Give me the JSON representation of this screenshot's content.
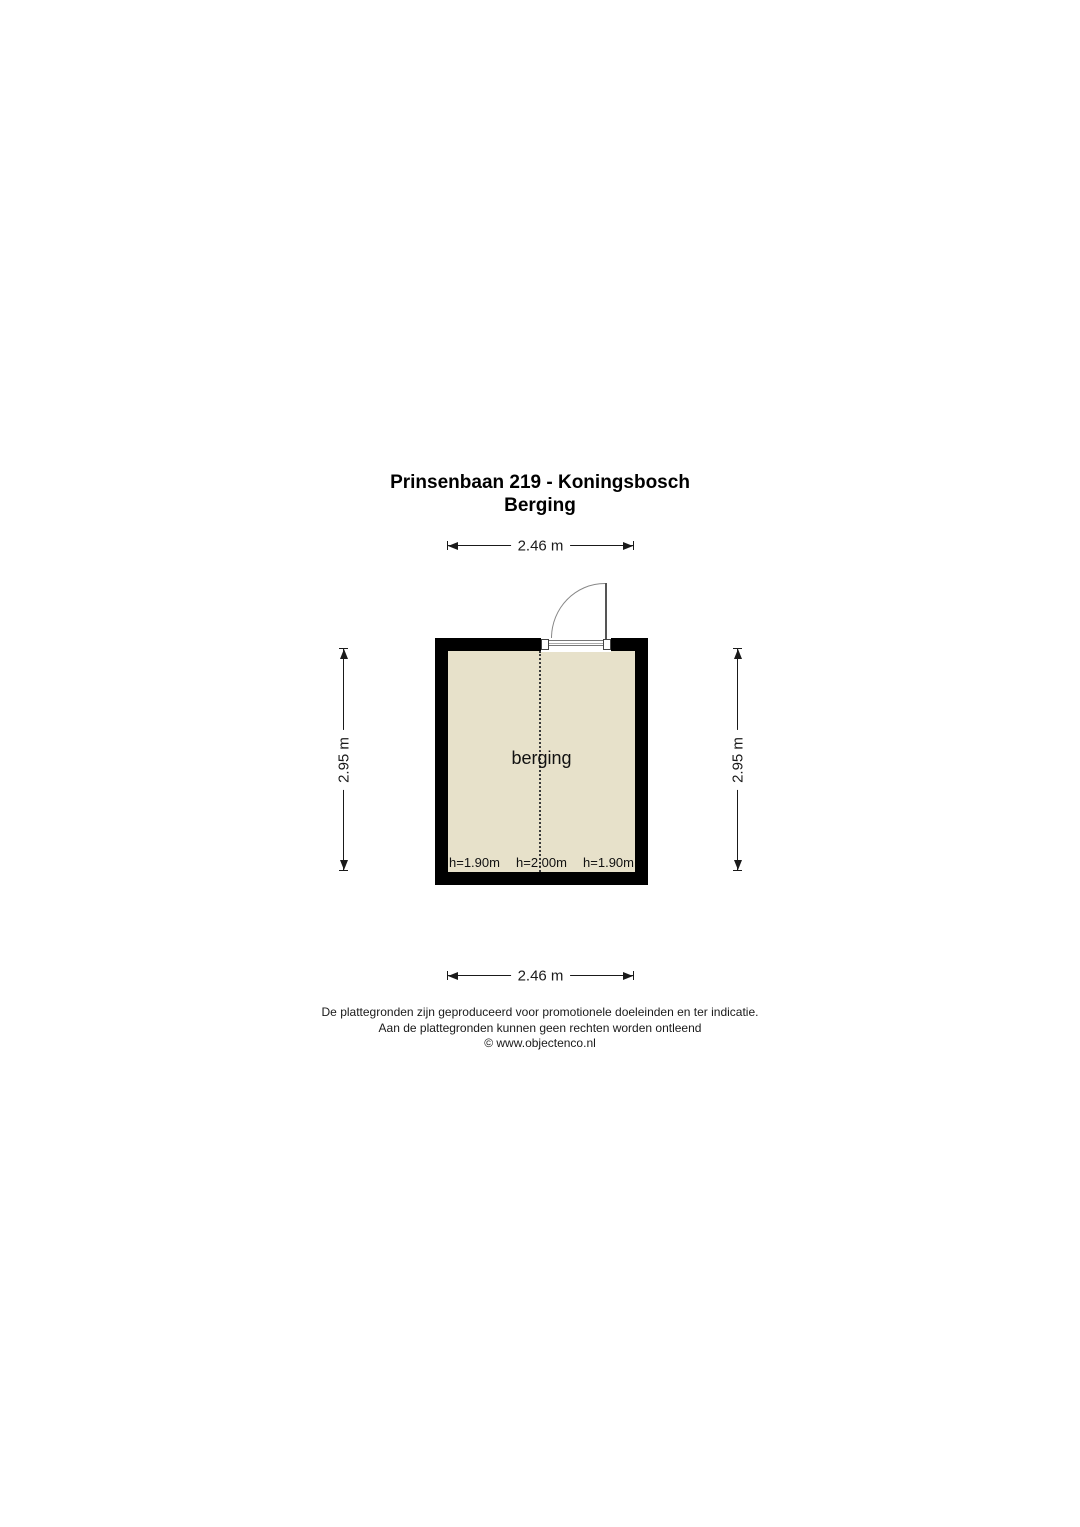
{
  "title": {
    "line1": "Prinsenbaan 219 - Koningsbosch",
    "line2": "Berging"
  },
  "dimensions": {
    "top": "2.46 m",
    "bottom": "2.46 m",
    "left": "2.95 m",
    "right": "2.95 m"
  },
  "floor_plan": {
    "room_label": "berging",
    "height_labels": [
      "h=1.90m",
      "h=2.00m",
      "h=1.90m"
    ],
    "colors": {
      "wall": "#000000",
      "floor": "#e7e1ca",
      "door_lines": "#888888",
      "dimension_lines": "#1a1a1a",
      "background": "#ffffff"
    }
  },
  "footer": {
    "line1": "De plattegronden zijn geproduceerd voor promotionele doeleinden en ter indicatie.",
    "line2": "Aan de plattegronden kunnen geen rechten worden ontleend",
    "line3": "© www.objectenco.nl"
  }
}
